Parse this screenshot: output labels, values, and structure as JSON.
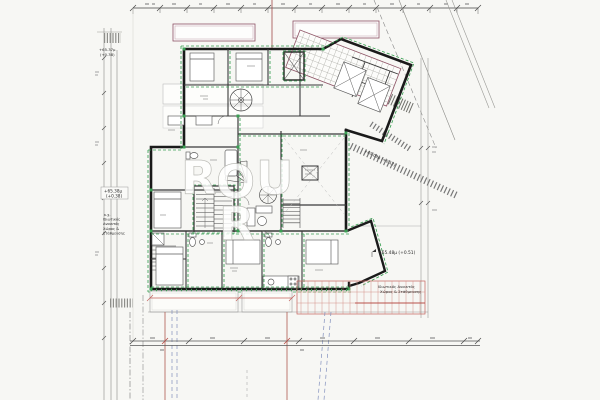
{
  "document": {
    "type": "architectural-floor-plan",
    "background": "#f7f7f4"
  },
  "labels": {
    "level_topleft": {
      "line1": "+65.37μ",
      "line2": "(+0.38)"
    },
    "level_left": {
      "line1": "+65.38μ",
      "line2": "(+0.38)"
    },
    "parking_left_lines": [
      "κ.χ.",
      "Ιδιωτικός",
      "Ανοικτός",
      "Χώρος &",
      "Στάθμευσης"
    ],
    "level_right": "+65.48μ (+0.51)",
    "parking_right_lines": [
      "Ιδιωτικός Ανοικτός",
      "Χώρος & Στάθμευσης"
    ],
    "sidewalk_level": "+65.09μ (+0.12)",
    "watermark_letters": [
      "R",
      "O",
      "U",
      "R"
    ]
  },
  "colors": {
    "walls": "#1a1a1a",
    "green_dashed": "#3aa053",
    "balcony_purple": "#8d5264",
    "dimension_red": "#c4625c",
    "guide_blue": "#8290bd",
    "hatch_gray": "#8e8e8a",
    "paper": "#f7f7f4"
  }
}
